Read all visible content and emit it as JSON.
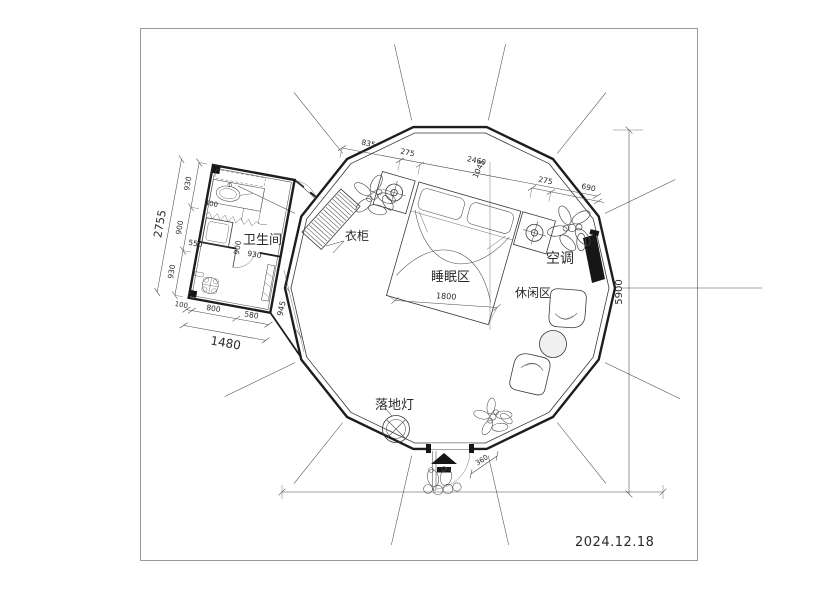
{
  "sheet": {
    "date": "2024.12.18"
  },
  "labels": {
    "bathroom": "卫生间",
    "wardrobe": "衣柜",
    "sleeping_area": "睡眠区",
    "air_conditioner": "空调",
    "leisure_area": "休闲区",
    "floor_lamp": "落地灯"
  },
  "dimensions": {
    "left_total": "2755",
    "left_segments": [
      "930",
      "900",
      "930"
    ],
    "bath_bottom_total": "1480",
    "bath_bottom_segments": [
      "100",
      "800",
      "580"
    ],
    "bath_right": "945",
    "bath_inner": {
      "sink": "400",
      "washer": "550",
      "lower_width": "900",
      "lower_depth": "930"
    },
    "top_segments": [
      "835",
      "275",
      "2460",
      "1045"
    ],
    "top_right_segments": [
      "275",
      "690"
    ],
    "bed_width": "1800",
    "overall_height": "5900",
    "entrance_step": "360"
  }
}
